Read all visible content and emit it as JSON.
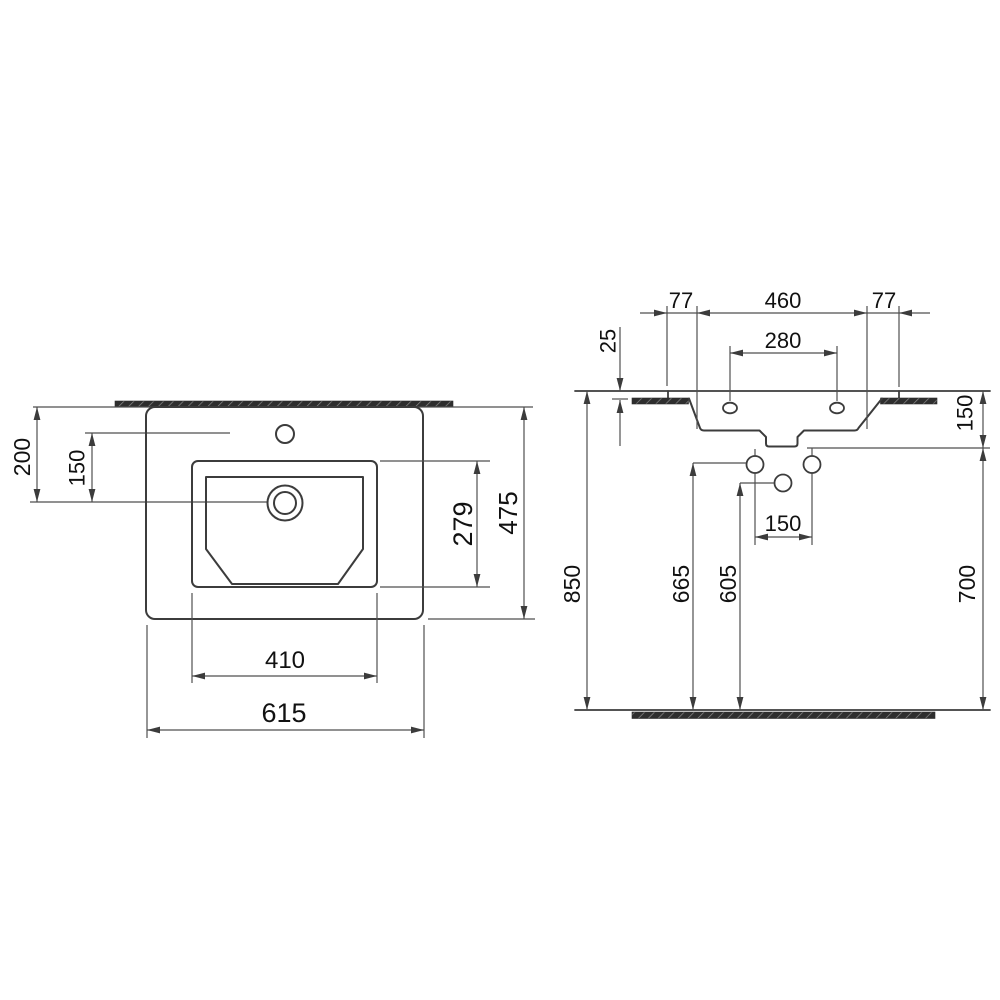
{
  "drawing": {
    "kind": "washbasin-installation-dimension-drawing",
    "top_view": {
      "edge_to_drain": "200",
      "faucet_to_drain": "150",
      "basin_depth": "279",
      "overall_depth": "475",
      "basin_width": "410",
      "overall_width": "615"
    },
    "front_view": {
      "left_edge_offset": "77",
      "opening_width": "460",
      "right_edge_offset": "77",
      "rim_above_counter": "25",
      "fixing_hole_spacing": "280",
      "rim_to_underside": "150",
      "rim_height_from_floor": "850",
      "supply_height_from_floor": "665",
      "drain_height_from_floor": "605",
      "supply_hole_spacing": "150",
      "underside_height_from_floor": "700"
    }
  }
}
